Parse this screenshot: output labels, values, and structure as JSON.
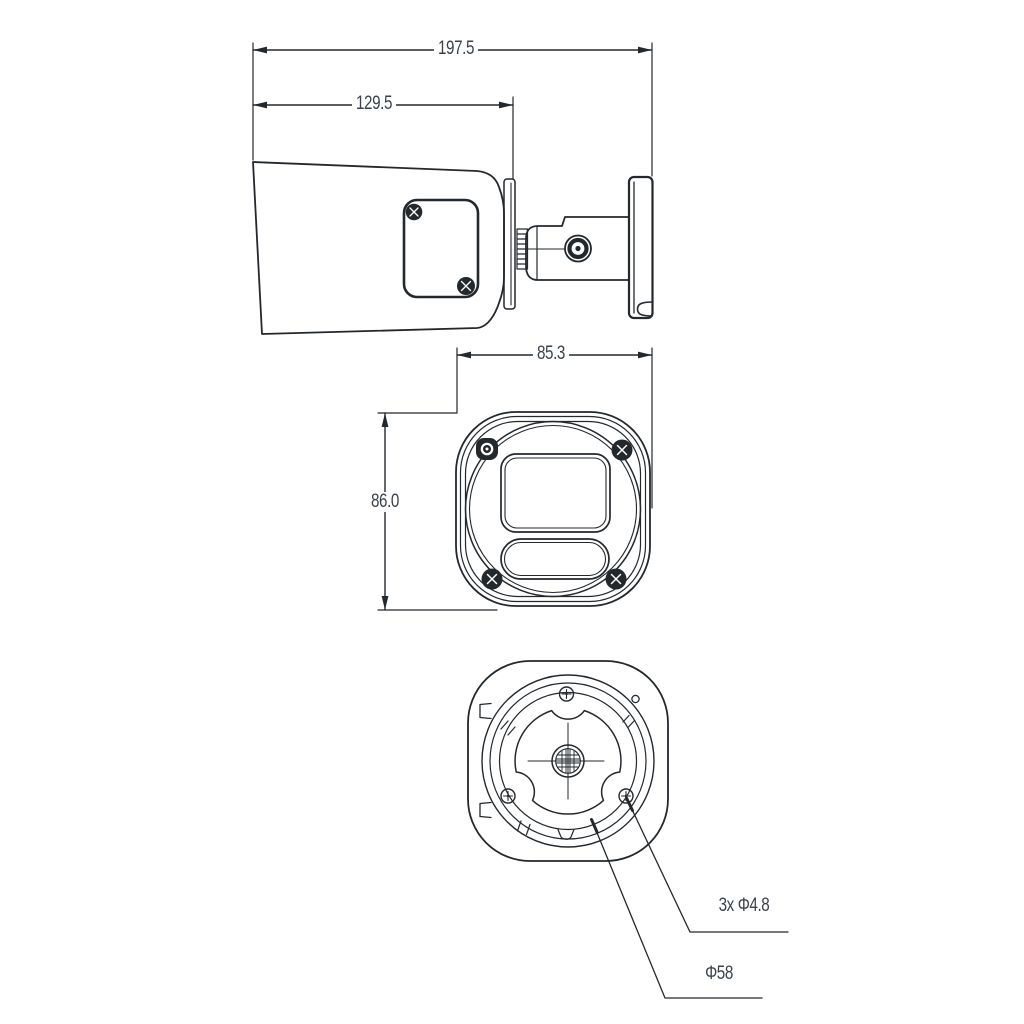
{
  "drawing": {
    "kind": "technical dimension drawing, bullet security camera (3 orthographic views)",
    "background": "#ffffff",
    "line_color": "#23282d",
    "text_color": "#39424b",
    "side_view": {
      "dims": {
        "overall_length": "197.5",
        "body_length": "129.5"
      }
    },
    "front_view": {
      "dims": {
        "width": "85.3",
        "height": "86.0"
      }
    },
    "rear_view": {
      "callouts": {
        "mounting_holes": "3x Φ4.8",
        "bolt_circle": "Φ58"
      }
    }
  }
}
